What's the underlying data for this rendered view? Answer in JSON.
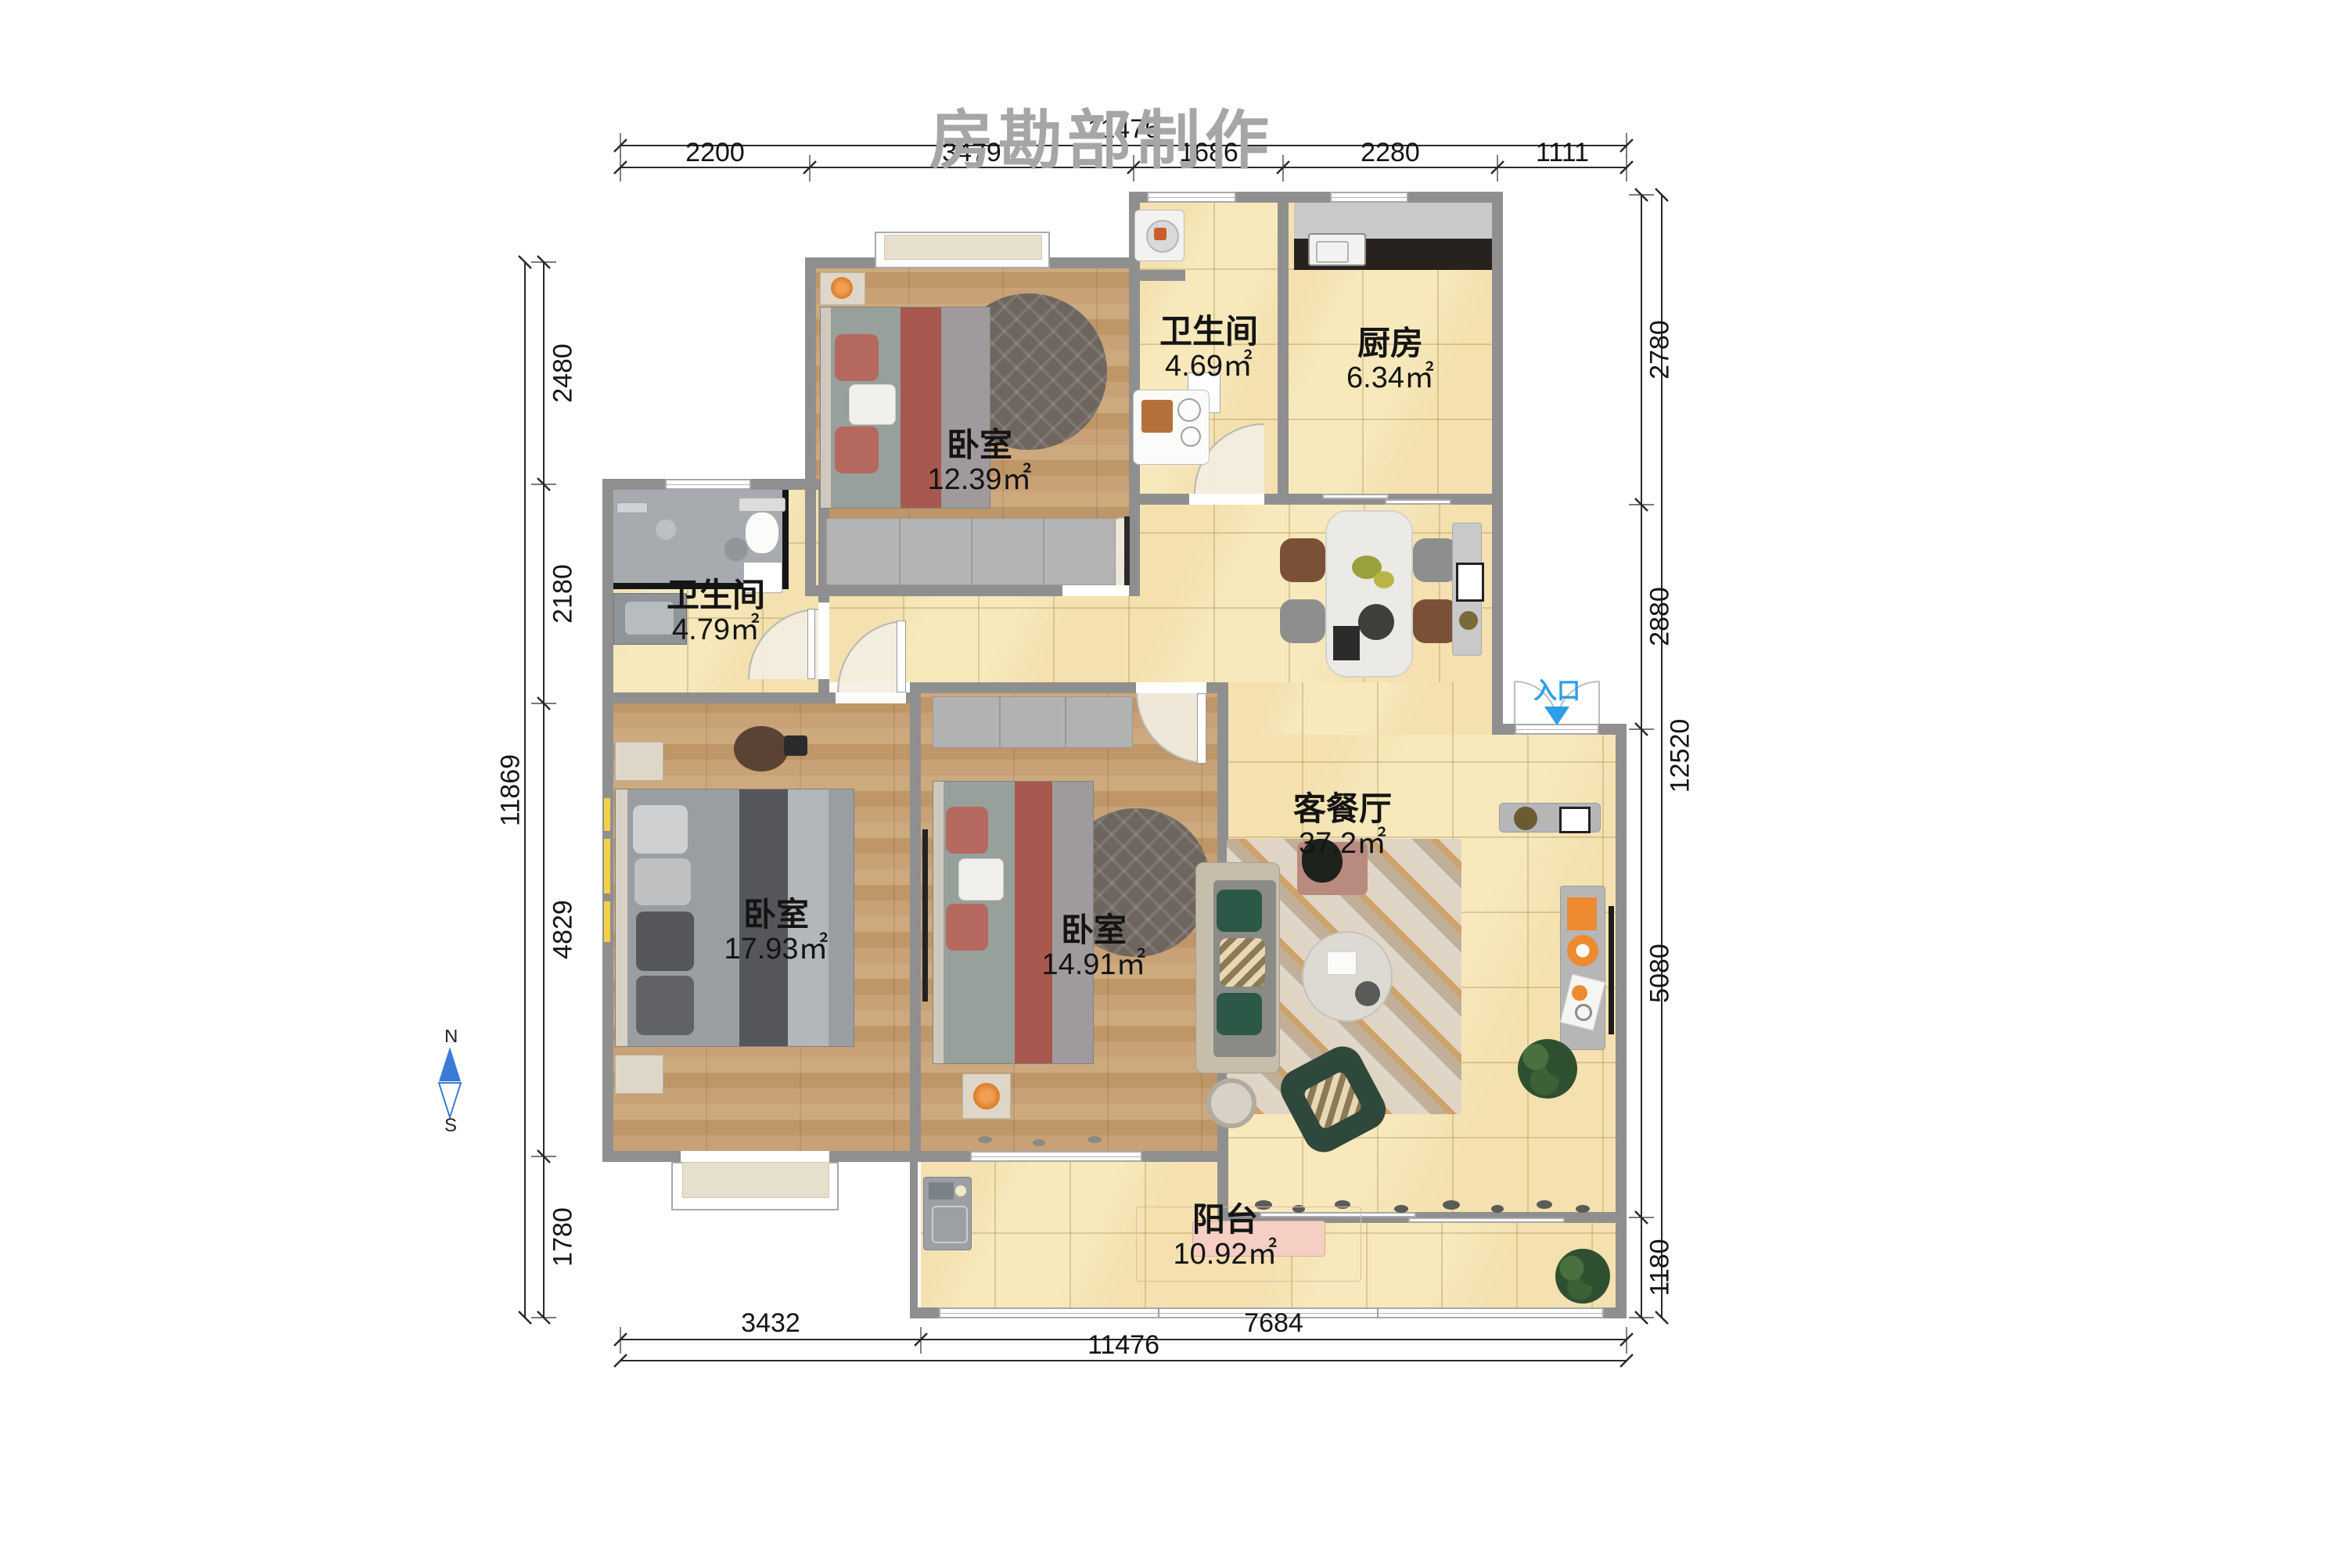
{
  "watermark": "房勘部制作",
  "compass": {
    "north": "N",
    "south": "S"
  },
  "entry": {
    "label": "入口"
  },
  "rooms": [
    {
      "id": "bedroom_top",
      "name": "卧室",
      "area": "12.39㎡"
    },
    {
      "id": "bath_top",
      "name": "卫生间",
      "area": "4.69㎡"
    },
    {
      "id": "kitchen",
      "name": "厨房",
      "area": "6.34㎡"
    },
    {
      "id": "bath_left",
      "name": "卫生间",
      "area": "4.79㎡"
    },
    {
      "id": "bedroom_left",
      "name": "卧室",
      "area": "17.93㎡"
    },
    {
      "id": "bedroom_mid",
      "name": "卧室",
      "area": "14.91㎡"
    },
    {
      "id": "living",
      "name": "客餐厅",
      "area": "37.2㎡"
    },
    {
      "id": "balcony",
      "name": "阳台",
      "area": "10.92㎡"
    }
  ],
  "dimensions": {
    "top": {
      "overall": "11476",
      "segments": [
        "2200",
        "3479",
        "1686",
        "2280",
        "1111"
      ]
    },
    "bottom": {
      "overall": "11476",
      "segments": [
        "3432",
        "7684"
      ]
    },
    "left": {
      "overall": "11869",
      "segments": [
        "2480",
        "2180",
        "4829",
        "1780"
      ]
    },
    "right": {
      "overall": "12520",
      "segments": [
        "2780",
        "2880",
        "5080",
        "1180"
      ]
    }
  },
  "colors": {
    "wall": "#8f8f8f",
    "tile_floor": "#f7e9bc",
    "wood_floor": "#c49e72",
    "accent_entry": "#2b9fe8",
    "dim_line": "#2a2a2a",
    "watermark": "#a6a6a6"
  }
}
